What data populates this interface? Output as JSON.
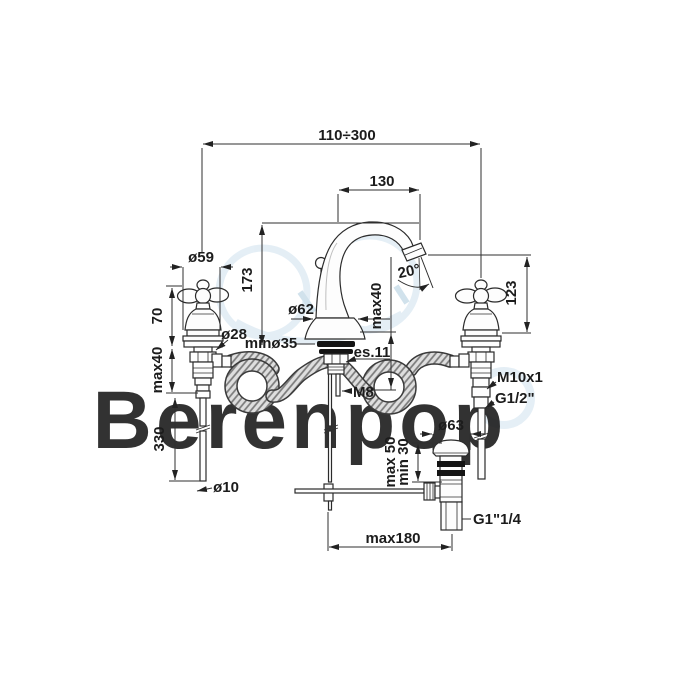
{
  "drawing": {
    "type": "technical-dimension-drawing",
    "subject": "3-hole-basin-mixer-with-popup-waste",
    "watermark": "Berenpop",
    "colors": {
      "line": "#2b2b2b",
      "watermark_blue": "#cfe2ef",
      "watermark_gray": "#e9e9e9"
    },
    "dims": {
      "spread": "110÷300",
      "spout_reach": "130",
      "spout_height": "173",
      "outlet_angle": "20°",
      "outlet_height": "123",
      "handle_diameter": "ø59",
      "handle_height": "70",
      "deck_thickness_left": "max40",
      "spout_base_diameter": "ø62",
      "deck_thickness_center": "max40",
      "shank_diameter": "ø28",
      "min_hole_diameter": "minø35",
      "hex_size": "es.11",
      "stud_thread": "M8",
      "supply_nut_thread": "M10x1",
      "hose_thread": "G1/2\"",
      "pipe_length": "330",
      "pipe_diameter": "ø10",
      "drain_flange_diameter": "ø63",
      "drain_deck_max": "max 50",
      "drain_deck_min": "min 30",
      "drain_thread": "G1\"1/4",
      "rod_reach": "max180"
    }
  }
}
